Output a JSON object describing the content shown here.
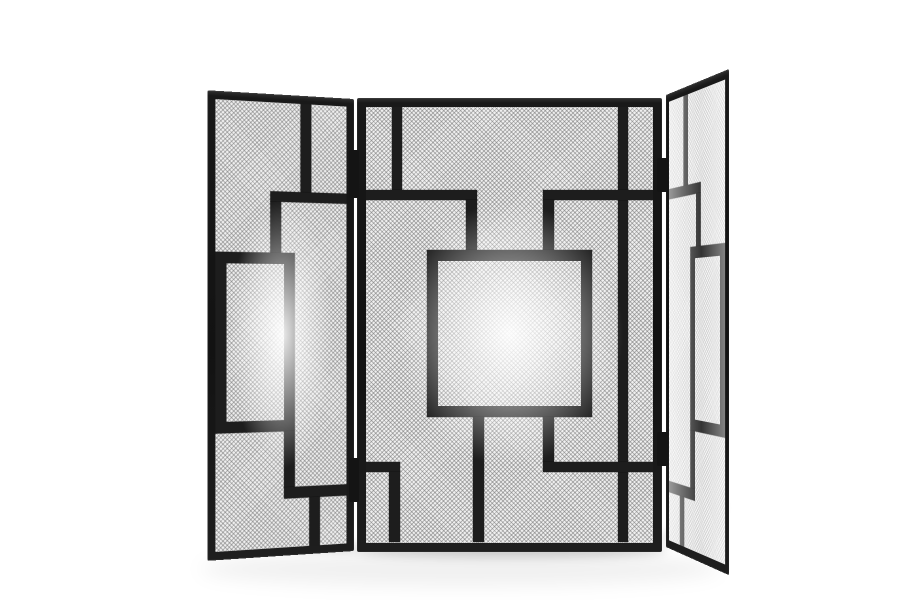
{
  "scene": {
    "description": "Product photo: three-panel black metal folding fireplace screen with geometric rectangular bar pattern over silver wire mesh, standing on a white studio background with soft floor shadow",
    "background_color": "#ffffff",
    "frame_color": "#1a1a1a",
    "bar_color": "#1d1d1d",
    "mesh_base_color": "#efefef",
    "mesh_wire_color": "#696969",
    "hinge_color": "#141414"
  },
  "panels": {
    "left": {
      "x": 204,
      "y": 99,
      "width": 150,
      "height": 452,
      "frame": 8,
      "transform": "perspective(1300px) rotateY(20deg)",
      "transform_origin": "100% 47%",
      "mesh_light": false,
      "bars": [
        {
          "id": "top-vertical",
          "x": 86,
          "y": 0,
          "w": 11,
          "h": 87
        },
        {
          "id": "upper-horizontal",
          "x": 55,
          "y": 87,
          "w": 79,
          "h": 10
        },
        {
          "id": "upper-drop-vertical",
          "x": 55,
          "y": 97,
          "w": 11,
          "h": 50
        },
        {
          "id": "middle-rectangle",
          "x": 0,
          "y": 147,
          "w": 80,
          "h": 175,
          "border": 11
        },
        {
          "id": "lower-drop-vertical",
          "x": 69,
          "y": 322,
          "w": 11,
          "h": 55
        },
        {
          "id": "lower-horizontal",
          "x": 69,
          "y": 377,
          "w": 65,
          "h": 11
        },
        {
          "id": "bottom-vertical",
          "x": 95,
          "y": 388,
          "w": 11,
          "h": 48
        }
      ]
    },
    "center": {
      "x": 357,
      "y": 98,
      "width": 305,
      "height": 454,
      "frame": 9,
      "transform": "none",
      "transform_origin": "center",
      "mesh_light": false,
      "bars": [
        {
          "id": "top-left-vertical",
          "x": 26,
          "y": 0,
          "w": 10,
          "h": 85
        },
        {
          "id": "right-long-vertical",
          "x": 252,
          "y": 0,
          "w": 10,
          "h": 435
        },
        {
          "id": "upper-horizontal-left",
          "x": 0,
          "y": 83,
          "w": 111,
          "h": 10
        },
        {
          "id": "upper-horizontal-right",
          "x": 177,
          "y": 83,
          "w": 110,
          "h": 10
        },
        {
          "id": "upper-drop-left",
          "x": 100,
          "y": 93,
          "w": 11,
          "h": 50
        },
        {
          "id": "upper-drop-right",
          "x": 177,
          "y": 93,
          "w": 11,
          "h": 50
        },
        {
          "id": "central-square",
          "x": 61,
          "y": 143,
          "w": 165,
          "h": 167,
          "border": 11
        },
        {
          "id": "lower-left-vertical",
          "x": 107,
          "y": 310,
          "w": 11,
          "h": 125
        },
        {
          "id": "lower-drop-right",
          "x": 177,
          "y": 310,
          "w": 11,
          "h": 45
        },
        {
          "id": "lower-horizontal-left",
          "x": 0,
          "y": 355,
          "w": 34,
          "h": 10
        },
        {
          "id": "lower-horizontal-right",
          "x": 177,
          "y": 355,
          "w": 110,
          "h": 10
        },
        {
          "id": "corner-vertical",
          "x": 23,
          "y": 365,
          "w": 11,
          "h": 70
        }
      ]
    },
    "right": {
      "x": 666,
      "y": 95,
      "width": 150,
      "height": 452,
      "frame": 8,
      "transform": "perspective(1300px) rotateY(-68deg)",
      "transform_origin": "0% 48%",
      "mesh_light": true,
      "bars": [
        {
          "id": "top-vertical",
          "x": 37,
          "y": 0,
          "w": 11,
          "h": 87
        },
        {
          "id": "upper-horizontal",
          "x": 0,
          "y": 87,
          "w": 79,
          "h": 10
        },
        {
          "id": "upper-drop-vertical",
          "x": 68,
          "y": 97,
          "w": 11,
          "h": 50
        },
        {
          "id": "middle-rectangle",
          "x": 54,
          "y": 147,
          "w": 80,
          "h": 175,
          "border": 11
        },
        {
          "id": "lower-drop-vertical",
          "x": 54,
          "y": 322,
          "w": 11,
          "h": 55
        },
        {
          "id": "lower-horizontal",
          "x": 0,
          "y": 377,
          "w": 65,
          "h": 11
        },
        {
          "id": "bottom-vertical",
          "x": 28,
          "y": 388,
          "w": 11,
          "h": 48
        }
      ]
    }
  },
  "hinges": [
    {
      "id": "left-hinge-top",
      "x": 349,
      "y": 150,
      "w": 10,
      "h": 48
    },
    {
      "id": "left-hinge-bottom",
      "x": 349,
      "y": 458,
      "w": 10,
      "h": 44
    },
    {
      "id": "right-hinge-top",
      "x": 657,
      "y": 158,
      "w": 11,
      "h": 34
    },
    {
      "id": "right-hinge-bottom",
      "x": 657,
      "y": 432,
      "w": 11,
      "h": 34
    }
  ],
  "shadows": [
    {
      "id": "ambient-floor-reflection",
      "x": 200,
      "y": 552,
      "w": 520,
      "h": 34,
      "opacity": 0.06,
      "blur": 9,
      "rotate": 0
    },
    {
      "id": "left-panel-contact-shadow",
      "x": 214,
      "y": 534,
      "w": 146,
      "h": 13,
      "opacity": 0.17,
      "blur": 5,
      "rotate": 6
    },
    {
      "id": "center-panel-contact-shadow",
      "x": 356,
      "y": 544,
      "w": 310,
      "h": 13,
      "opacity": 0.2,
      "blur": 5,
      "rotate": 0
    },
    {
      "id": "right-panel-contact-shadow",
      "x": 654,
      "y": 518,
      "w": 74,
      "h": 11,
      "opacity": 0.14,
      "blur": 5,
      "rotate": -30
    }
  ]
}
